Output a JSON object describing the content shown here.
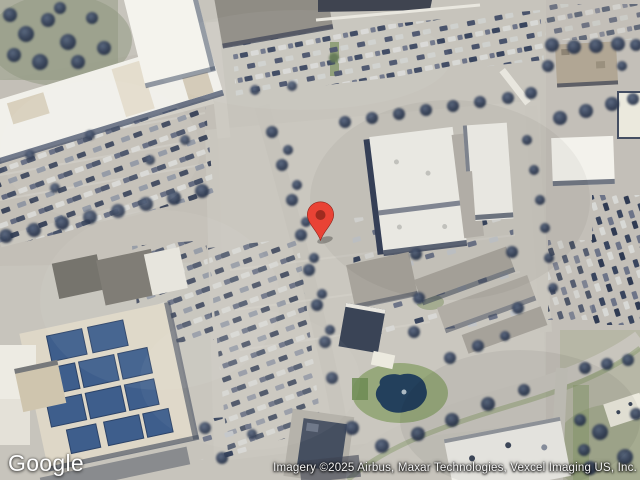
{
  "branding": {
    "logo_text": "Google"
  },
  "attribution": {
    "text": "Imagery ©2025 Airbus, Maxar Technologies, Vexcel Imaging US, Inc."
  },
  "marker": {
    "color": "#E94335",
    "inner_color": "#9E2B1F"
  },
  "colors": {
    "pavement": "#c7c4bc",
    "roof_white": "#f2f1eb",
    "pond": "#23405c",
    "grass": "#81945f",
    "solar_panel": "#3e5e8c"
  }
}
